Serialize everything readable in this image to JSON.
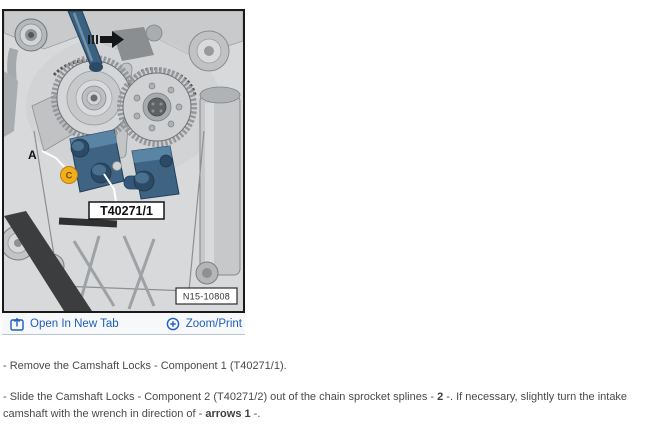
{
  "figure": {
    "diagram": {
      "label_a": "A",
      "marker_glyph": "C",
      "tool_box_label": "T40271/1",
      "figure_code": "N15-10808"
    },
    "toolbar": {
      "open_in_new_tab_label": "Open In New Tab",
      "zoom_print_label": "Zoom/Print"
    }
  },
  "instructions": {
    "step1_text": "-  Remove the Camshaft Locks - Component 1 (T40271/1).",
    "step2_segments": [
      {
        "text": "-  Slide the Camshaft Locks - Component 2 (T40271/2) out of the chain sprocket splines - "
      },
      {
        "text": "2"
      },
      {
        "text": " -. If necessary, slightly turn the intake camshaft with the wrench in direction of - "
      },
      {
        "text": "arrows 1"
      },
      {
        "text": " -."
      }
    ]
  },
  "colors": {
    "link_blue": "#1d5ebe",
    "tool_steel_blue": "#3e6383",
    "marker_yellow": "#f2ae1d",
    "diagram_background": "#d7d9db"
  }
}
